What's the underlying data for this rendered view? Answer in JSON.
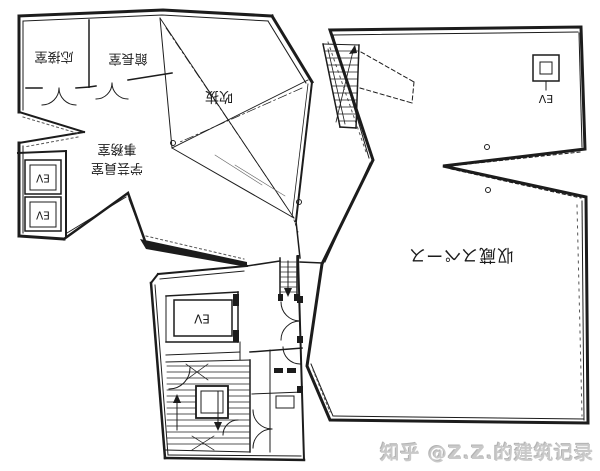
{
  "plan": {
    "rooms": {
      "reception": "応接室",
      "director": "館長室",
      "atrium": "吹抜",
      "curator": "学芸員室",
      "office": "事務室",
      "storage": "収蔵スペース"
    },
    "elevator": "EV"
  },
  "watermark": {
    "text": "知乎 @Z.Z.的建筑记录"
  },
  "colors": {
    "ink": "#1c1c1c",
    "paper": "#ffffff",
    "watermark": "#c9c9c9"
  }
}
